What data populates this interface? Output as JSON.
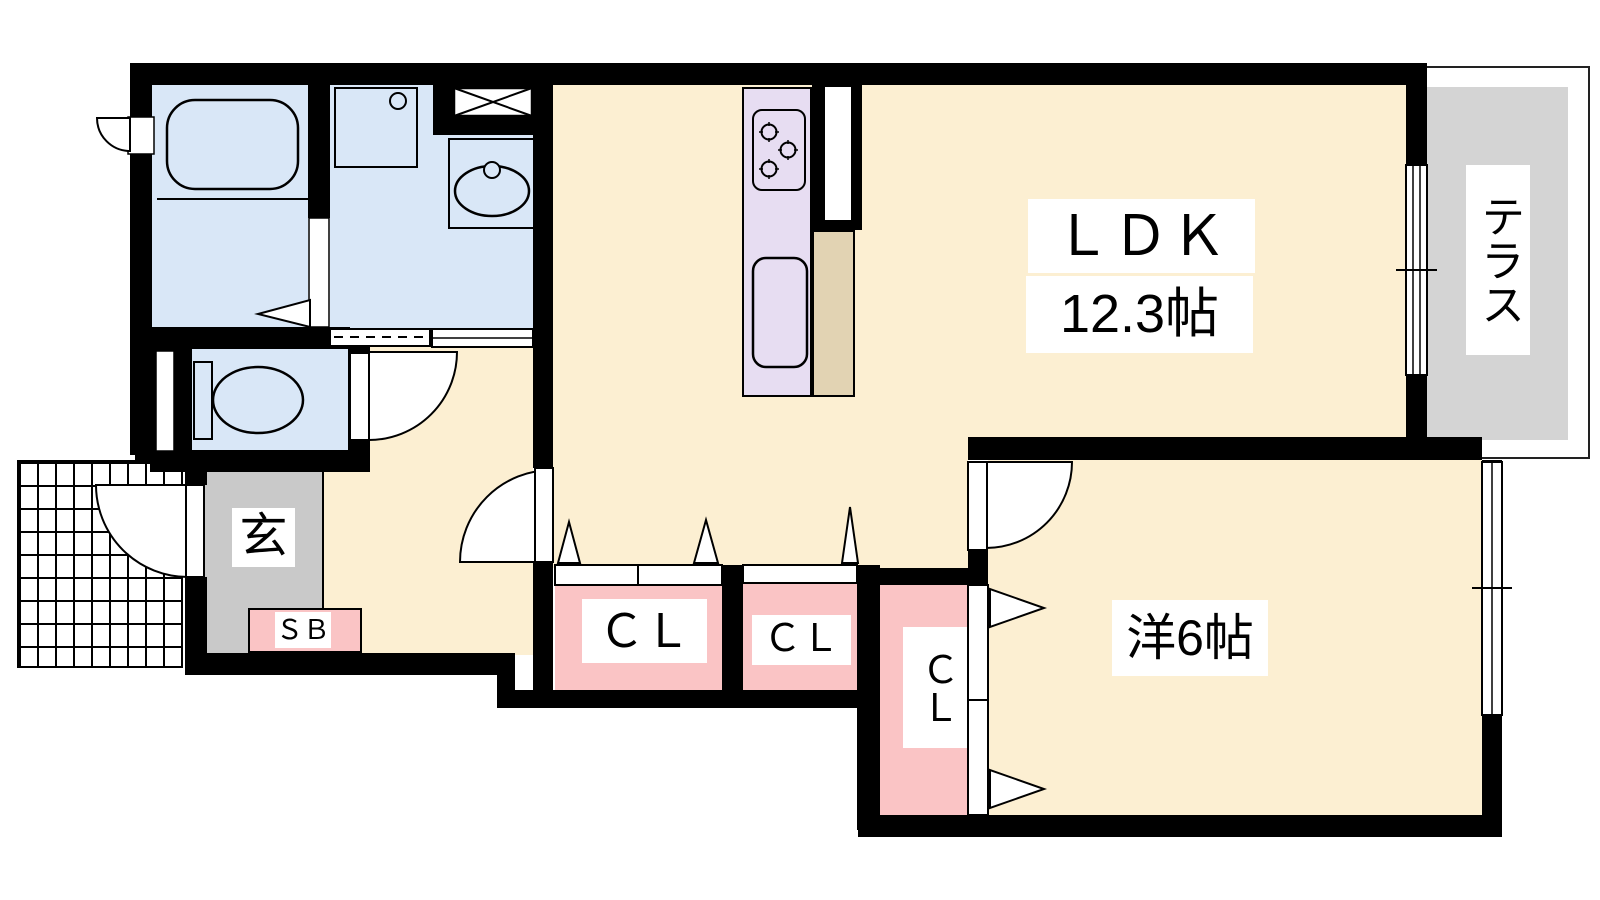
{
  "floorplan": {
    "type": "apartment-madori",
    "rooms": {
      "ldk": {
        "label": "ＬＤＫ",
        "size": "12.3帖"
      },
      "western_room": {
        "label": "洋6帖"
      },
      "terrace": {
        "label": "テラス"
      },
      "entrance": {
        "label": "玄"
      },
      "shoe_box": {
        "label": "ＳＢ"
      },
      "closet_1": {
        "label": "ＣＬ"
      },
      "closet_2": {
        "label": "ＣＬ"
      },
      "closet_3": {
        "label": "ＣＬ"
      }
    },
    "fixtures": [
      "bathtub",
      "washer-pan",
      "vanity-sink",
      "toilet",
      "gas-stove",
      "kitchen-sink"
    ],
    "colors": {
      "room_beige": "#FCEFD2",
      "wet_area_blue": "#D9E7F7",
      "kitchen_lavender": "#E7DDF2",
      "counter_tan": "#E2D3B3",
      "closet_pink": "#FAC4C5",
      "entrance_gray": "#C9C9C9",
      "terrace_gray": "#D4D4D4",
      "wall_black": "#000000"
    }
  }
}
